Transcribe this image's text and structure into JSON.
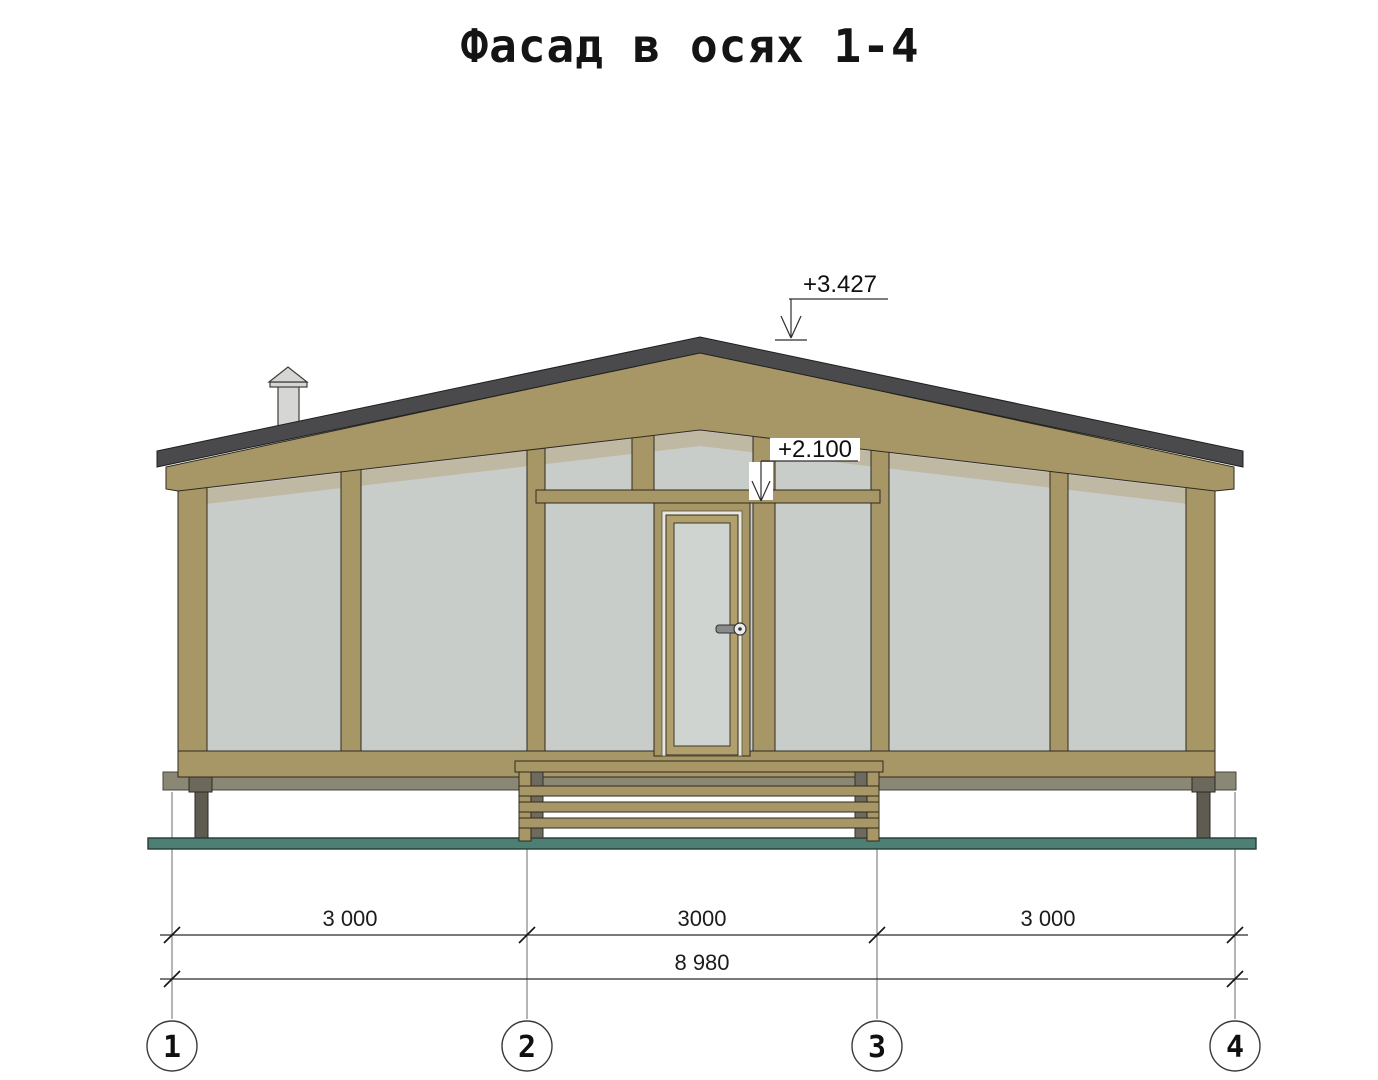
{
  "title": "Фасад в осях 1-4",
  "levels": {
    "ridge": "+3.427",
    "door_top": "+2.100"
  },
  "dimensions": {
    "segment_1": "3 000",
    "segment_2": "3000",
    "segment_3": "3 000",
    "total": "8 980"
  },
  "axes": {
    "a1": "1",
    "a2": "2",
    "a3": "3",
    "a4": "4"
  },
  "colors": {
    "wood_frame": "#a89766",
    "glazing": "#c9cdca",
    "roof_fascia": "#4a4a4c",
    "ground": "#4e7f74",
    "plinth": "#8a8874",
    "pile": "#5f5b50",
    "chimney": "#d6d6d4",
    "frame_shadow": "#bdb49c",
    "drawing_line": "#2b2b2b"
  }
}
